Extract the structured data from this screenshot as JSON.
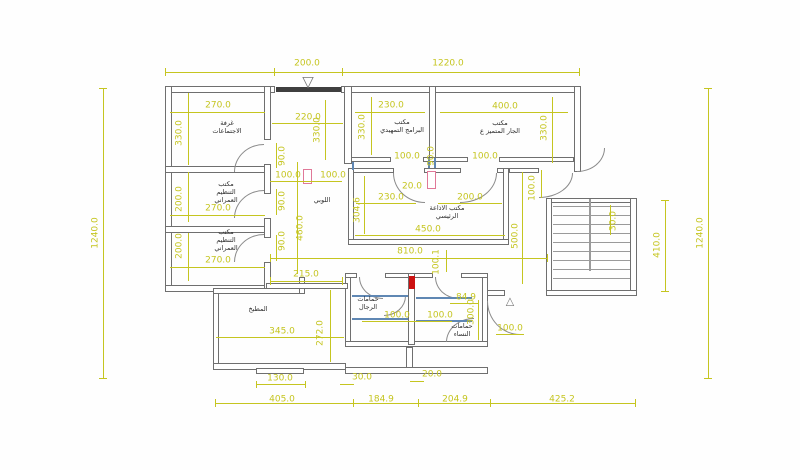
{
  "title": "architectural-floor-plan",
  "colors": {
    "background": "#fefefe",
    "wall": "#6f6f6f",
    "wall_dark": "#3f3f3f",
    "dimension": "#c5c520",
    "label": "#2e2e2e",
    "accent_red": "#cc1111",
    "accent_pink": "#e07898",
    "accent_blue": "#5f87b3"
  },
  "rooms": [
    {
      "label": "غرفة\nالاجتماعات",
      "x": 227,
      "y": 127
    },
    {
      "label": "مكتب\nالبرامج التمهيدي",
      "x": 402,
      "y": 126
    },
    {
      "label": "مكتب\nالجار المتميز ع",
      "x": 500,
      "y": 127
    },
    {
      "label": "مكتب\nالتنظيم\nالعمراني",
      "x": 226,
      "y": 192
    },
    {
      "label": "مكتب\nالتنظيم\nالعمراني",
      "x": 226,
      "y": 240
    },
    {
      "label": "اللوبي",
      "x": 322,
      "y": 200
    },
    {
      "label": "مكتب الاذاعة\nالرئيسي",
      "x": 447,
      "y": 212
    },
    {
      "label": "حمامات\nالرجال",
      "x": 368,
      "y": 303
    },
    {
      "label": "حمامات\nالنساء",
      "x": 462,
      "y": 330
    },
    {
      "label": "المطبخ",
      "x": 258,
      "y": 309
    }
  ],
  "dimensions": [
    {
      "text": "200.0",
      "x": 307,
      "y": 64
    },
    {
      "text": "1220.0",
      "x": 448,
      "y": 64
    },
    {
      "text": "1240.0",
      "x": 96,
      "y": 233,
      "rot": 1
    },
    {
      "text": "1240.0",
      "x": 701,
      "y": 233,
      "rot": 1
    },
    {
      "text": "410.0",
      "x": 658,
      "y": 245,
      "rot": 1
    },
    {
      "text": "270.0",
      "x": 218,
      "y": 106
    },
    {
      "text": "330.0",
      "x": 180,
      "y": 133,
      "rot": 1
    },
    {
      "text": "220.0",
      "x": 308,
      "y": 118
    },
    {
      "text": "330.0",
      "x": 318,
      "y": 130,
      "rot": 1
    },
    {
      "text": "230.0",
      "x": 391,
      "y": 106
    },
    {
      "text": "330.0",
      "x": 363,
      "y": 127,
      "rot": 1
    },
    {
      "text": "400.0",
      "x": 505,
      "y": 107
    },
    {
      "text": "330.0",
      "x": 545,
      "y": 128,
      "rot": 1
    },
    {
      "text": "90.0",
      "x": 283,
      "y": 156,
      "rot": 1
    },
    {
      "text": "100.0",
      "x": 288,
      "y": 176
    },
    {
      "text": "100.0",
      "x": 333,
      "y": 176
    },
    {
      "text": "100.0",
      "x": 407,
      "y": 157
    },
    {
      "text": "90.0",
      "x": 432,
      "y": 156,
      "rot": 1
    },
    {
      "text": "100.0",
      "x": 485,
      "y": 157
    },
    {
      "text": "100.0",
      "x": 533,
      "y": 188,
      "rot": 1
    },
    {
      "text": "20.0",
      "x": 412,
      "y": 187
    },
    {
      "text": "230.0",
      "x": 391,
      "y": 198
    },
    {
      "text": "200.0",
      "x": 470,
      "y": 198
    },
    {
      "text": "304.6",
      "x": 358,
      "y": 210,
      "rot": 1
    },
    {
      "text": "450.0",
      "x": 428,
      "y": 230
    },
    {
      "text": "500.0",
      "x": 516,
      "y": 236,
      "rot": 1
    },
    {
      "text": "200.0",
      "x": 180,
      "y": 199,
      "rot": 1
    },
    {
      "text": "270.0",
      "x": 218,
      "y": 209
    },
    {
      "text": "200.0",
      "x": 180,
      "y": 246,
      "rot": 1
    },
    {
      "text": "270.0",
      "x": 218,
      "y": 261
    },
    {
      "text": "90.0",
      "x": 283,
      "y": 201,
      "rot": 1
    },
    {
      "text": "90.0",
      "x": 283,
      "y": 241,
      "rot": 1
    },
    {
      "text": "460.0",
      "x": 301,
      "y": 228,
      "rot": 1
    },
    {
      "text": "215.0",
      "x": 306,
      "y": 275
    },
    {
      "text": "810.0",
      "x": 410,
      "y": 252
    },
    {
      "text": "100.1",
      "x": 437,
      "y": 262,
      "rot": 1
    },
    {
      "text": "30.0",
      "x": 614,
      "y": 221,
      "rot": 1
    },
    {
      "text": "100.0",
      "x": 397,
      "y": 316
    },
    {
      "text": "100.0",
      "x": 440,
      "y": 316
    },
    {
      "text": "84.9",
      "x": 466,
      "y": 298
    },
    {
      "text": "300.0",
      "x": 472,
      "y": 312,
      "rot": 1
    },
    {
      "text": "100.0",
      "x": 510,
      "y": 329
    },
    {
      "text": "345.0",
      "x": 282,
      "y": 332
    },
    {
      "text": "272.0",
      "x": 321,
      "y": 333,
      "rot": 1
    },
    {
      "text": "130.0",
      "x": 280,
      "y": 379
    },
    {
      "text": "30.0",
      "x": 362,
      "y": 378
    },
    {
      "text": "20.0",
      "x": 432,
      "y": 375
    },
    {
      "text": "405.0",
      "x": 282,
      "y": 400
    },
    {
      "text": "184.9",
      "x": 381,
      "y": 400
    },
    {
      "text": "204.9",
      "x": 455,
      "y": 400
    },
    {
      "text": "425.2",
      "x": 562,
      "y": 400
    }
  ],
  "markers": [
    {
      "name": "entrance-marker-icon",
      "glyph": "▽",
      "x": 308,
      "y": 82,
      "size": 15
    },
    {
      "name": "side-entrance-marker-icon",
      "glyph": "△",
      "x": 510,
      "y": 301,
      "size": 11
    }
  ]
}
